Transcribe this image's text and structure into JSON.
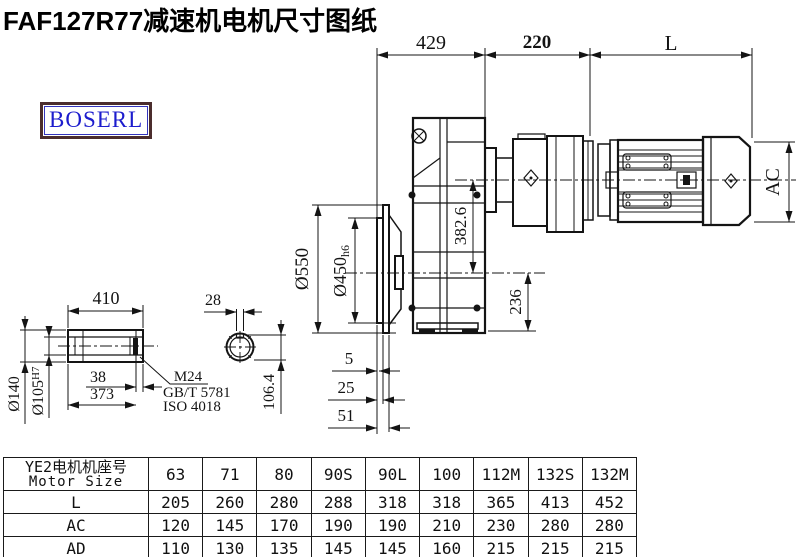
{
  "page": {
    "title": "FAF127R77减速机电机尺寸图纸"
  },
  "logo": {
    "text": "BOSERL"
  },
  "drawing": {
    "top_dims": {
      "d429": "429",
      "d220": "220",
      "dL": "L"
    },
    "main_dims": {
      "d550": "Ø550",
      "d450": "Ø450",
      "d450_suffix": "h6",
      "d382": "382.6",
      "d236": "236",
      "dAC": "AC",
      "d5": "5",
      "d25": "25",
      "d51": "51"
    },
    "shaft_detail": {
      "d410": "410",
      "d38": "38",
      "d373": "373",
      "d140": "Ø140",
      "d105": "Ø105",
      "d105_sup": "H7",
      "leader_m24": "M24",
      "leader_gbt": "GB/T 5781",
      "leader_iso": "ISO 4018",
      "d28": "28",
      "d106": "106.4"
    }
  },
  "table": {
    "header_line1": "YE2电机机座号",
    "header_line2": "Motor Size",
    "columns": [
      "63",
      "71",
      "80",
      "90S",
      "90L",
      "100",
      "112M",
      "132S",
      "132M"
    ],
    "rows": [
      {
        "label": "L",
        "values": [
          "205",
          "260",
          "280",
          "288",
          "318",
          "318",
          "365",
          "413",
          "452"
        ]
      },
      {
        "label": "AC",
        "values": [
          "120",
          "145",
          "170",
          "190",
          "190",
          "210",
          "230",
          "280",
          "280"
        ]
      },
      {
        "label": "AD",
        "values": [
          "110",
          "130",
          "135",
          "145",
          "145",
          "160",
          "215",
          "215",
          "215"
        ]
      }
    ]
  }
}
